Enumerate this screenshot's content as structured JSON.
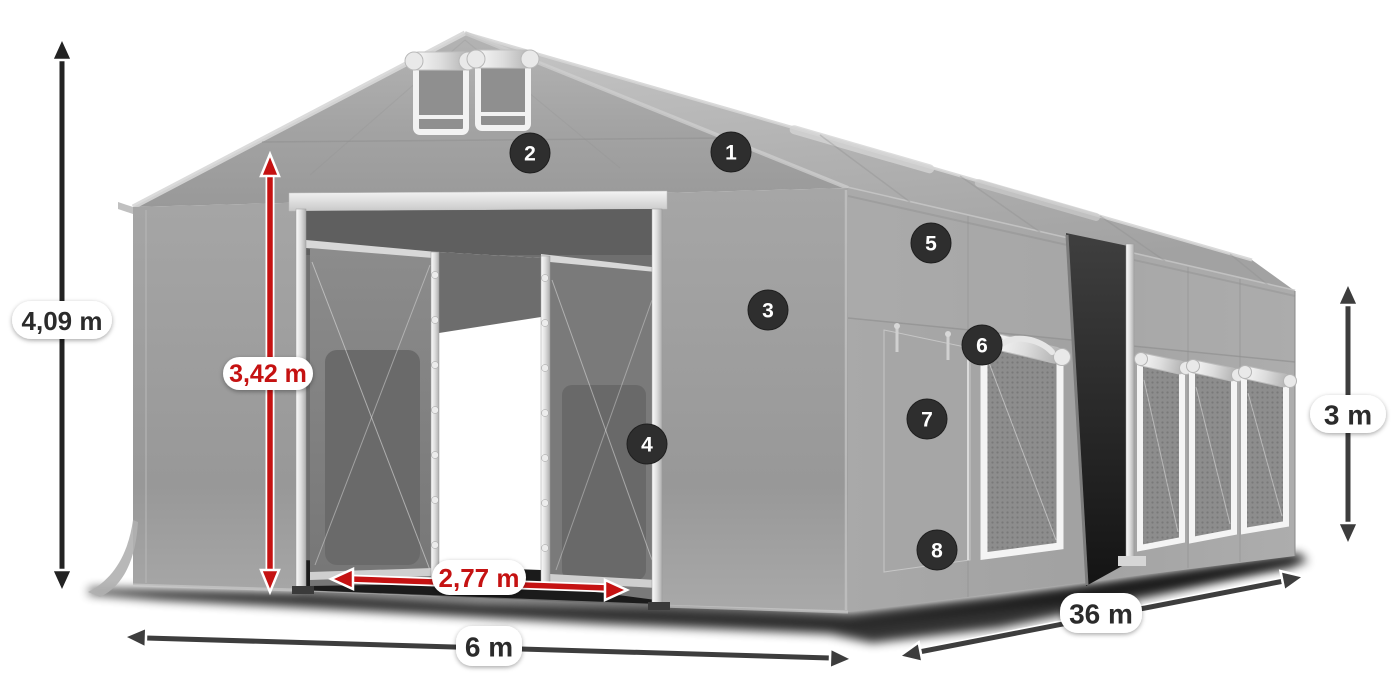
{
  "diagram": {
    "background": "#ffffff",
    "dimensions": {
      "total_height": "4,09 m",
      "entrance_height": "3,42 m",
      "entrance_width": "2,77 m",
      "width": "6 m",
      "length": "36 m",
      "side_height": "3 m"
    },
    "callouts": [
      {
        "number": "1"
      },
      {
        "number": "2"
      },
      {
        "number": "3"
      },
      {
        "number": "4"
      },
      {
        "number": "5"
      },
      {
        "number": "6"
      },
      {
        "number": "7"
      },
      {
        "number": "8"
      }
    ],
    "colors": {
      "accent_red": "#c51212",
      "arrow_dark": "#3d3d3d",
      "arrow_black": "#232323",
      "badge_background": "#2e2e2e",
      "label_pill": "#ffffff",
      "fabric_gray": "#9e9e9e"
    }
  }
}
